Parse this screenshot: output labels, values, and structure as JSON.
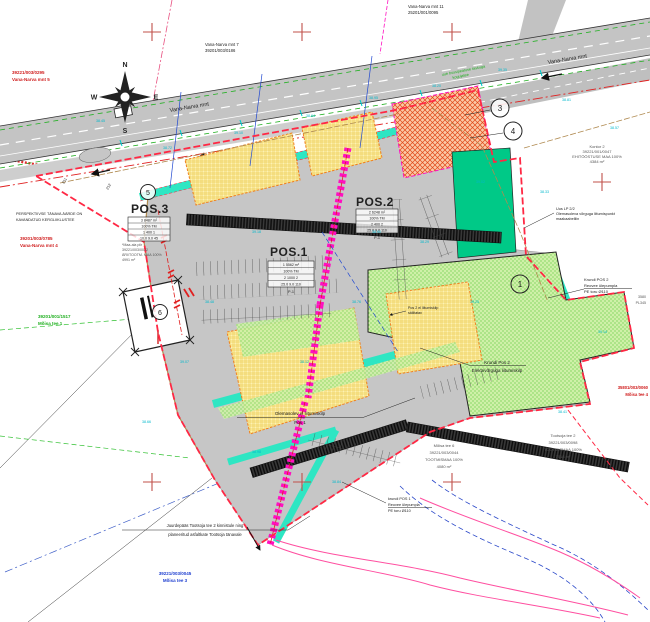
{
  "compass": {
    "n": "N",
    "e": "E",
    "s": "S",
    "w": "W"
  },
  "road": {
    "name": "Vana-Narva mnt",
    "name2": "Vana-Narva mnt",
    "note1": "uue bussipeatuse taskuga",
    "note2": "kogujatee"
  },
  "positions": {
    "pos1": {
      "label": "POS.1",
      "rows": [
        "1   5562 m²",
        "100% TM",
        "2   1000   2",
        "25.0   9.0   110"
      ],
      "caption": "P-1"
    },
    "pos2": {
      "label": "POS.2",
      "rows": [
        "2   6248 m²",
        "100% TM",
        "2   400   2",
        "25.0   9.0   110"
      ],
      "caption": "P-1"
    },
    "pos3": {
      "label": "POS.3",
      "rows": [
        "3   8487 m²",
        "100% TM",
        "1   400   1",
        "10.0   9.0   45"
      ]
    }
  },
  "markers": {
    "m1": "1",
    "m3": "3",
    "m4": "4",
    "m5": "5",
    "m6": "6"
  },
  "labels": {
    "nw": [
      "39221/003/0295",
      "Vana-Narva mnt 5"
    ],
    "n7": [
      "Vana-Narva mnt 7",
      "39201/003/0186"
    ],
    "ne11": [
      "Vana-Narva mnt 11",
      "25201/001/0095"
    ],
    "kontor2": [
      "Kontor 2",
      "39221/001/0047",
      "EHITÖÖSTUSE MAA 100%",
      "4384 m²"
    ],
    "uuslp": [
      "Uus LP 2/2",
      "Olemasoleva võrguga liitumispunkt",
      "maakaabelliin"
    ],
    "reovee2": [
      "Krundi POS 2",
      "Reovee ülepumpla",
      "PE toru Ø110"
    ],
    "elekter2": [
      "Krundi Pos 2",
      "Elektrivõrguga liitumiskilp"
    ],
    "kilp1": [
      "Olemasolev el liitumiskilp",
      "Pos 1"
    ],
    "kilp2": [
      "Pos 2 el liitumiskilp",
      "säilitatav"
    ],
    "reovee1": [
      "krundi POS 1",
      "Reovee ülepumpla",
      "PE toru Ø110"
    ],
    "juurdepaas": [
      "Juurdepääs Tootsoja tee 2 kinnistule ning",
      "planeeritud asfaltkate Tootsoja tänavale"
    ],
    "moisa3": [
      "39221/003/0045",
      "Mõisa tee 3"
    ],
    "moisa1": [
      "39201/001/1517",
      "Mõisa tee 1"
    ],
    "vana4": [
      "39201/003/0785",
      "Vana-Narva mnt 4"
    ],
    "persp": [
      "PERSPEKTIIVSE TÄNAVA ÄÄRDE ON",
      "KAVANDATUD KERGLIIKLUSTEE"
    ],
    "maaala": [
      "*Maa-ala piir",
      "39221/003/0022",
      "ÄRI/TOOTM. MAA 100%",
      "4991 m²"
    ],
    "tootsoja2": [
      "Tootsoja tee 2",
      "39221/003/0098",
      "TOOTMISMAA 100%",
      "7018 m²"
    ],
    "moisa6": [
      "Mõisa tee 6",
      "39221/003/0044",
      "TOOTMISMAA 100%",
      "4080 m²"
    ],
    "se": [
      "35801/003/0060",
      "Mõisa tee 4"
    ],
    "edge": [
      "3580",
      "PL345"
    ],
    "p211": "211",
    "p212": "212"
  },
  "elevations": [
    "38.45",
    "38.72",
    "39.10",
    "38.64",
    "38.95",
    "38.20",
    "39.35",
    "38.81",
    "38.57",
    "39.02",
    "38.33",
    "38.90",
    "39.18",
    "38.48",
    "38.76",
    "39.25",
    "38.12",
    "38.98",
    "38.41",
    "39.07",
    "38.66",
    "38.29",
    "38.84",
    "39.14"
  ],
  "colors": {
    "boundary": "#ff2844",
    "teal": "#2ee6c3",
    "magenta": "#ff10c0",
    "orange_hatch": "#e04818",
    "yellow_area": "#fdf2b3",
    "green_area": "#cff0a8",
    "green_solid": "#00c987",
    "road_gray": "#c4c4c4",
    "cross_red": "#c0504a",
    "cyan_note": "#00b8cc"
  }
}
